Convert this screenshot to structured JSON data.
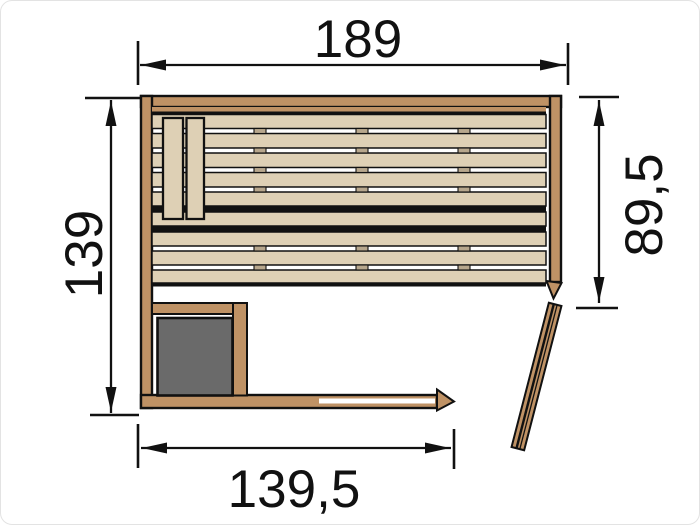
{
  "figure": {
    "kind": "sauna floor plan",
    "dimension_labels": {
      "top_width": "189",
      "left_height": "139",
      "right_inner_height": "89,5",
      "bottom_inner_width": "139,5"
    }
  },
  "colors": {
    "wall": "#bf9265",
    "bench": "#ded0b5",
    "clip": "#b7a78d",
    "heater": "#6a6a6a",
    "line": "#111111",
    "bg": "#ffffff"
  }
}
